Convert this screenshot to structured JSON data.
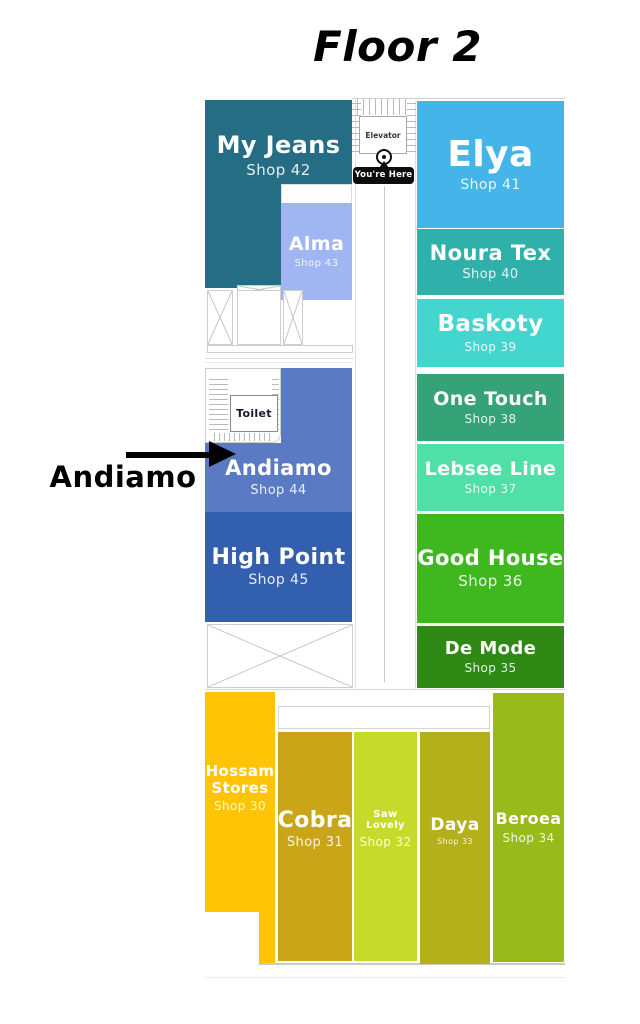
{
  "title": "Floor 2",
  "annotation": {
    "label": "Andiamo"
  },
  "markers": {
    "elevator_label": "Elevator",
    "you_are_here_label": "You're Here",
    "toilet_label": "Toilet"
  },
  "shops": {
    "my_jeans": {
      "name": "My Jeans",
      "shop": "Shop 42",
      "color": "#256c85"
    },
    "alma": {
      "name": "Alma",
      "shop": "Shop 43",
      "color": "#9fb6f2"
    },
    "andiamo": {
      "name": "Andiamo",
      "shop": "Shop 44",
      "color": "#5b7ac4"
    },
    "high_point": {
      "name": "High Point",
      "shop": "Shop 45",
      "color": "#3360ae"
    },
    "elya": {
      "name": "Elya",
      "shop": "Shop 41",
      "color": "#45b4e8"
    },
    "noura_tex": {
      "name": "Noura Tex",
      "shop": "Shop 40",
      "color": "#2fb0aa"
    },
    "baskoty": {
      "name": "Baskoty",
      "shop": "Shop 39",
      "color": "#43d6ce"
    },
    "one_touch": {
      "name": "One Touch",
      "shop": "Shop 38",
      "color": "#35a377"
    },
    "lebsee_line": {
      "name": "Lebsee Line",
      "shop": "Shop 37",
      "color": "#4fdfa7"
    },
    "good_house": {
      "name": "Good House",
      "shop": "Shop 36",
      "color": "#3eb81e"
    },
    "de_mode": {
      "name": "De Mode",
      "shop": "Shop 35",
      "color": "#2e8a14"
    },
    "hossam_stores": {
      "name": "Hossam Stores",
      "shop": "Shop 30",
      "color": "#ffc405"
    },
    "cobra": {
      "name": "Cobra",
      "shop": "Shop 31",
      "color": "#c9a517"
    },
    "saw_lovely": {
      "name": "Saw Lovely",
      "shop": "Shop 32",
      "color": "#c5da2b"
    },
    "daya": {
      "name": "Daya",
      "shop": "Shop 33",
      "color": "#b4b019"
    },
    "beroea": {
      "name": "Beroea",
      "shop": "Shop 34",
      "color": "#98ba1b"
    }
  }
}
